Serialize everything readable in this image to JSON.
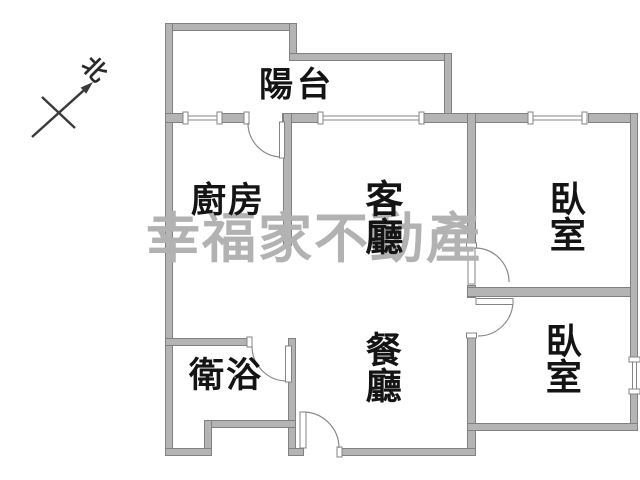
{
  "plan": {
    "type": "apartment-floor-plan",
    "background": "#ffffff"
  },
  "compass": {
    "label": "北"
  },
  "watermark": {
    "text": "幸福家不動產",
    "color": "#b2b2b2"
  },
  "rooms": [
    {
      "id": "balcony",
      "label": "陽台",
      "orientation": "horizontal"
    },
    {
      "id": "kitchen",
      "label": "廚房",
      "orientation": "horizontal"
    },
    {
      "id": "living-room",
      "label": "客廳",
      "orientation": "vertical"
    },
    {
      "id": "dining-room",
      "label": "餐廳",
      "orientation": "vertical"
    },
    {
      "id": "bathroom",
      "label": "衛浴",
      "orientation": "horizontal"
    },
    {
      "id": "bedroom-north",
      "label": "臥室",
      "orientation": "vertical"
    },
    {
      "id": "bedroom-south",
      "label": "臥室",
      "orientation": "vertical"
    }
  ],
  "colors": {
    "wall_fill": "#b4b4b4",
    "wall_edge": "#818181",
    "line": "#848484",
    "text": "#141414"
  }
}
